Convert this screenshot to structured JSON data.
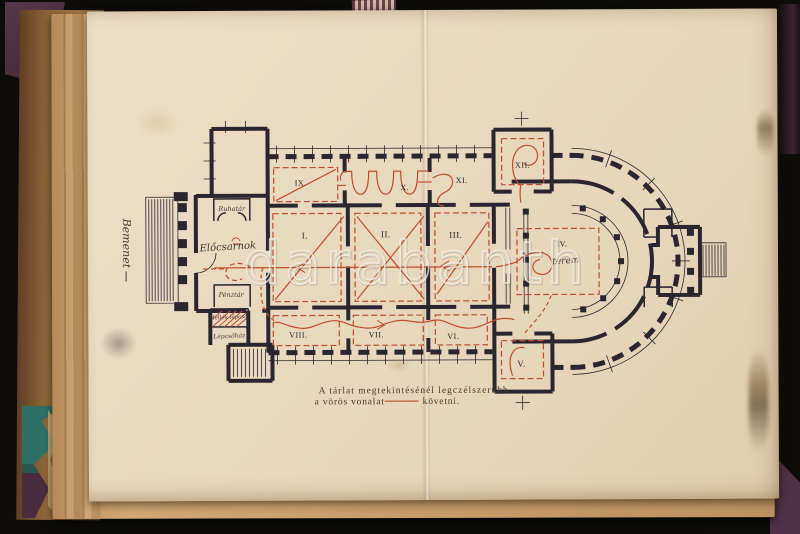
{
  "watermark": {
    "text": "darabanth"
  },
  "plate": {
    "caption": {
      "line1": "A tárlat megtekintésénél legczélszerűbb",
      "line2_start": "a vörös vonalat",
      "line2_end": "követni."
    },
    "plan": {
      "rooms": [
        {
          "numeral": "I."
        },
        {
          "numeral": "II."
        },
        {
          "numeral": "III."
        },
        {
          "numeral": "IV."
        },
        {
          "numeral": "V."
        },
        {
          "numeral": "VI."
        },
        {
          "numeral": "VII."
        },
        {
          "numeral": "VIII."
        },
        {
          "numeral": "IX."
        },
        {
          "numeral": "X."
        },
        {
          "numeral": "XI."
        },
        {
          "numeral": "XII."
        }
      ],
      "handwritten": {
        "entrance": "Bemenet",
        "hall": "Előcsarnok",
        "room": "terem",
        "cloakroom": "Ruhatár",
        "ticket_office": "Pénztár",
        "side_stair": "Mellék lépcső",
        "stairwell": "Lépcsőház"
      },
      "colors": {
        "ink": "#2a2630",
        "route": "#bf4e2d",
        "paper": "#e9d9bf",
        "cover": "#503045",
        "underlay_teal": "#2f6f66"
      }
    }
  }
}
